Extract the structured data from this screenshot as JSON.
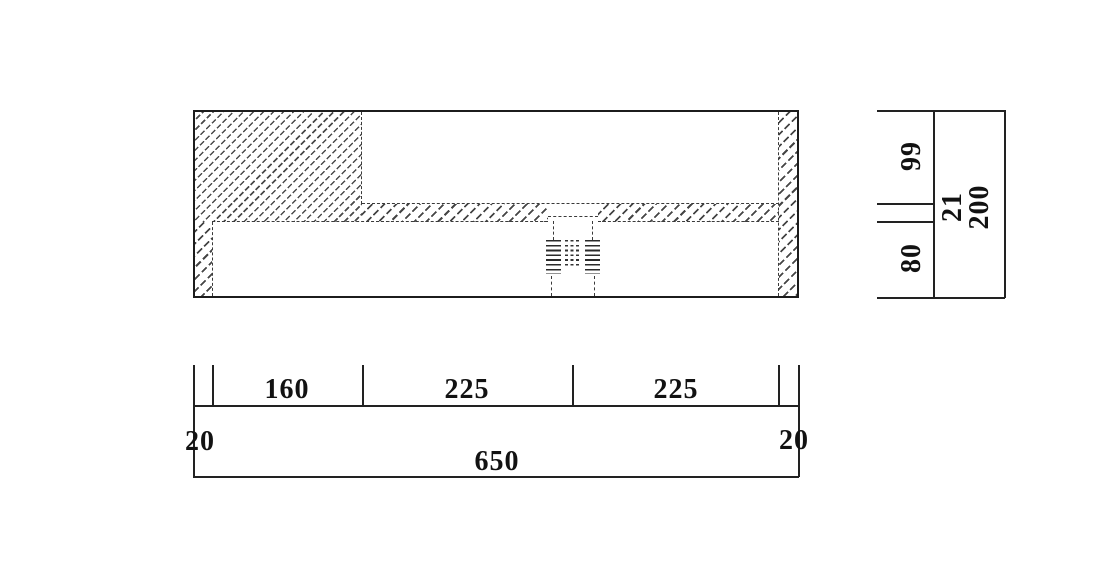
{
  "drawing": {
    "type": "engineering-section",
    "views": {
      "section": "front cross-section with hatched walls, slab and hidden threaded drain",
      "right_dimension_chain": "vertical heights",
      "bottom_dimension_chain": "horizontal widths"
    }
  },
  "dimensions": {
    "bottom": {
      "left_wall": "20",
      "segment_1": "160",
      "segment_2": "225",
      "segment_3": "225",
      "right_wall": "20",
      "overall": "650"
    },
    "right": {
      "upper": "99",
      "middle": "21",
      "lower": "80",
      "overall": "200"
    }
  },
  "colors": {
    "line": "#1c1c1c",
    "background": "#ffffff"
  }
}
